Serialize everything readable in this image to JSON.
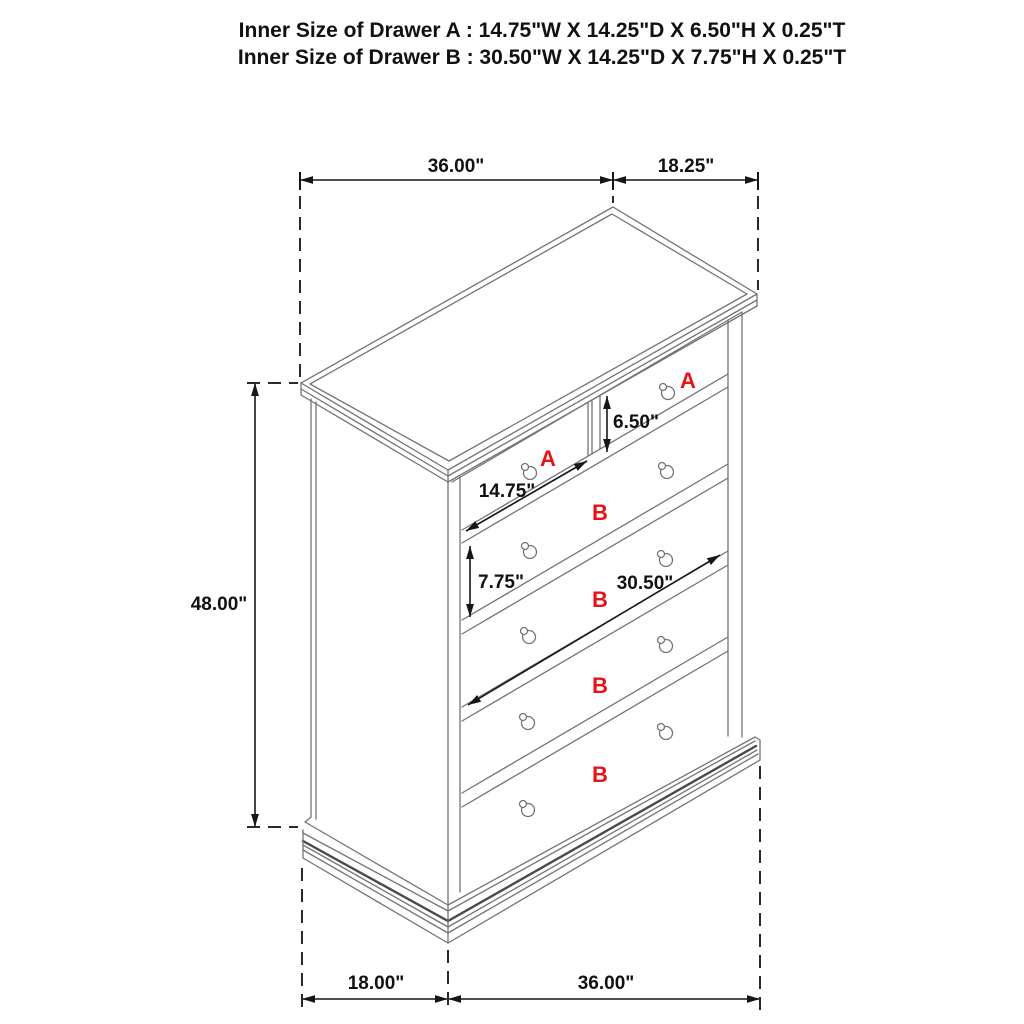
{
  "title": {
    "line1": "Inner Size of Drawer A : 14.75\"W X 14.25\"D X 6.50\"H X 0.25\"T",
    "line2": "Inner Size of Drawer B : 30.50\"W X 14.25\"D X 7.75\"H X 0.25\"T"
  },
  "dimensions": {
    "top_width": "36.00\"",
    "top_depth": "18.25\"",
    "overall_height": "48.00\"",
    "base_depth": "18.00\"",
    "base_width": "36.00\"",
    "drawer_a_inner_width": "14.75\"",
    "drawer_a_inner_height": "6.50\"",
    "drawer_b_inner_height": "7.75\"",
    "drawer_b_inner_width": "30.50\""
  },
  "drawer_labels": {
    "top_left": "A",
    "top_right": "A",
    "row2": "B",
    "row3": "B",
    "row4": "B",
    "row5": "B"
  },
  "colors": {
    "cabinet_line": "#747474",
    "dimension_line": "#161616",
    "drawer_label": "#e81219",
    "background": "#ffffff"
  }
}
